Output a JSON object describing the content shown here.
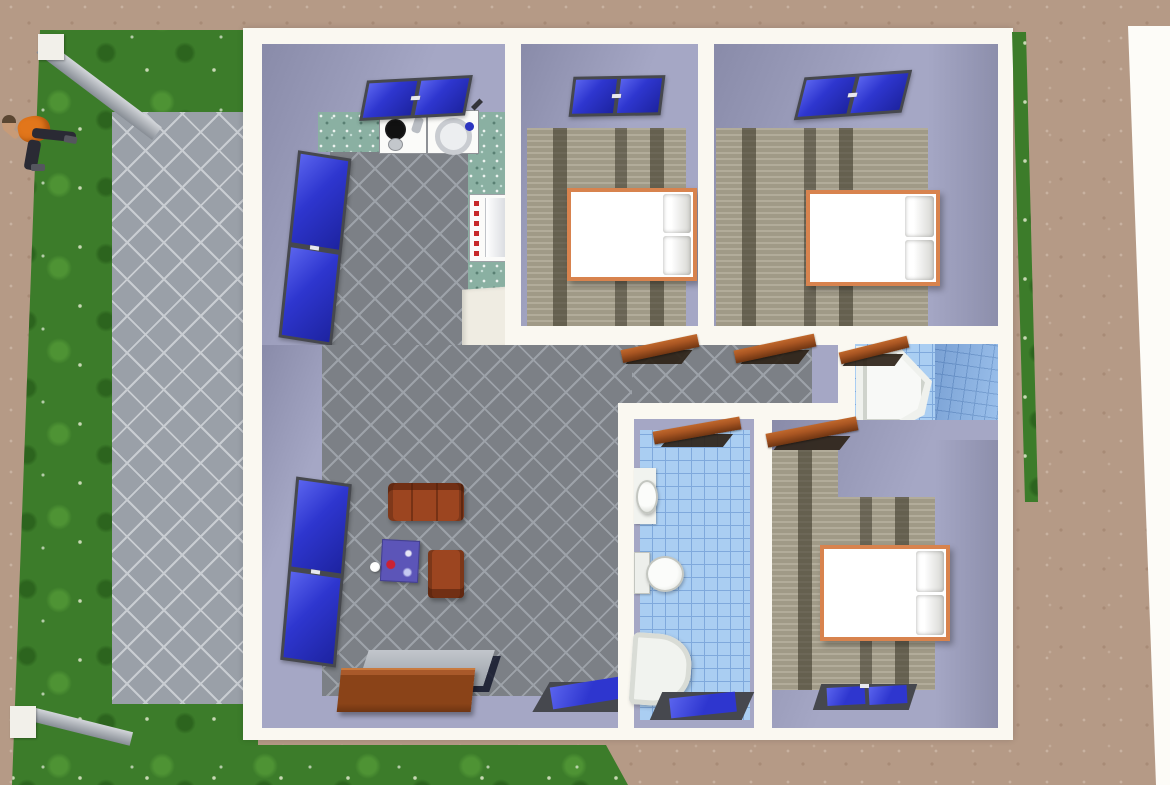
{
  "scene": {
    "type": "3d-floor-plan-render",
    "view": "top-down",
    "subject": "single-storey house with lawn, paved patio and garden walls",
    "visible_text": ""
  },
  "colors": {
    "dirt": "#b59a86",
    "page_edge": "#fdfcf8",
    "grass": "#3c7c2a",
    "grass_light": "#4e9334",
    "patio": "#9aa0a8",
    "patio_line": "#c9cdd2",
    "wall_white": "#faf8f1",
    "lavender": "#a5a7c5",
    "lavender_dark": "#898ba9",
    "floor_gray": "#7c8086",
    "floor_gray_line": "#9da2a9",
    "counter": "#8ab0a2",
    "wood": "#a7a08c",
    "tile": "#aacef2",
    "tile_line": "#7fa9dc",
    "tile_dark": "#92bcec",
    "window_blue": "#2e36cf",
    "window_blue_light": "#5a64ee",
    "frame": "#46484e",
    "door": "#a85522",
    "door_dark": "#6f3512",
    "shadow_brown": "#2e2318",
    "bed_frame": "#d8834e",
    "white": "#ffffff",
    "sofa": "#9c4520",
    "table": "#5c55b8",
    "sideboard": "#8a4318",
    "sideboard_top": "#aaaeb8",
    "fixture": "#f1f3ef",
    "fixture_shade": "#d6d9d3",
    "skin": "#c79b78",
    "shirt": "#e2761b",
    "pants": "#2a2a34"
  },
  "exterior": {
    "areas": [
      "dirt-ground",
      "lawn",
      "paved-patio",
      "lawn-strip-right",
      "page-edge"
    ],
    "garden_walls": [
      "upper-diagonal-wall-with-post",
      "lower-diagonal-wall-with-post"
    ],
    "person": {
      "pose": "walking",
      "parts": [
        "head",
        "shirt",
        "arm",
        "legs",
        "shoes"
      ]
    }
  },
  "house": {
    "wall_color_outer": "white",
    "wall_color_inner": "lavender",
    "rooms": [
      {
        "name": "kitchen",
        "floor": "gray-diagonal-tile",
        "items": [
          "top-window",
          "side-window",
          "stove-burner-unit",
          "sink-washer-unit",
          "counter-top",
          "counter-side",
          "refrigerator",
          "base-cabinet"
        ]
      },
      {
        "name": "living-room",
        "floor": "gray-diagonal-tile",
        "items": [
          "side-window",
          "bottom-window",
          "sofa",
          "armchair",
          "coffee-table",
          "ball",
          "sideboard"
        ]
      },
      {
        "name": "hallway",
        "floor": "gray-diagonal-tile",
        "items": [
          "bedroom-1-door",
          "bedroom-2-door"
        ]
      },
      {
        "name": "bedroom-1",
        "floor": "wood-plank",
        "items": [
          "top-window",
          "double-bed"
        ]
      },
      {
        "name": "bedroom-2",
        "floor": "wood-plank",
        "items": [
          "top-window",
          "double-bed"
        ]
      },
      {
        "name": "bedroom-3",
        "floor": "wood-plank",
        "items": [
          "door",
          "double-bed",
          "bottom-window"
        ]
      },
      {
        "name": "bathroom-1",
        "floor": "blue-tile",
        "items": [
          "door",
          "corner-bathtub",
          "toilet",
          "side-window"
        ]
      },
      {
        "name": "bathroom-2",
        "floor": "blue-tile",
        "items": [
          "door",
          "wash-basin",
          "toilet",
          "bathtub",
          "bottom-window"
        ]
      }
    ]
  }
}
